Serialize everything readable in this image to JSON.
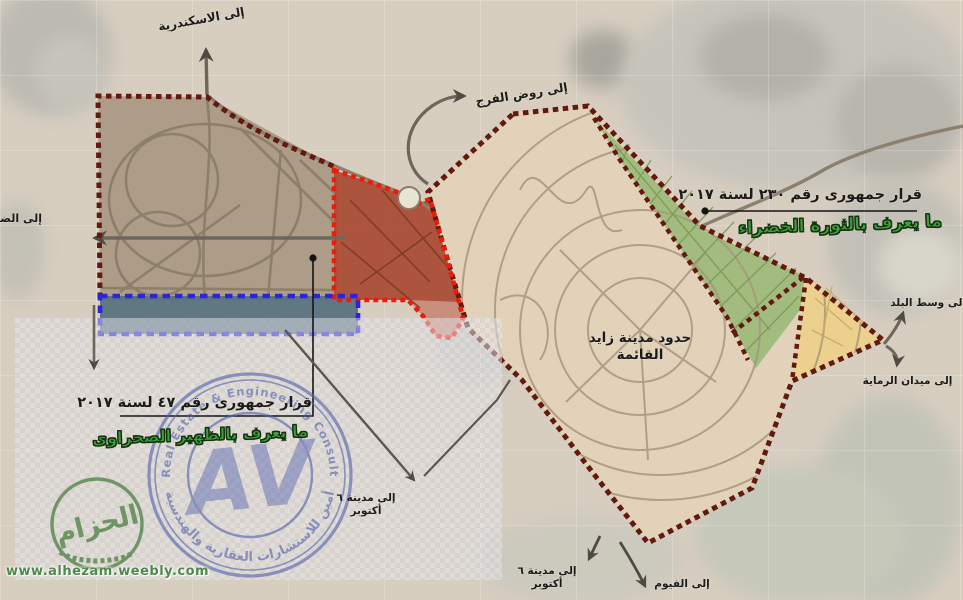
{
  "canvas": {
    "width": 963,
    "height": 600
  },
  "colors": {
    "sand": "#d8cec0",
    "zone-tan": "#ad9c87",
    "zone-beige": "#e2d2b9",
    "zone-green": "#a2bb7e",
    "zone-yellow": "#ecd08e",
    "zone-red": "#a84a32",
    "zone-red-light": "#c98f7d",
    "zone-slate": "#57707e",
    "dash-maroon": "#63190e",
    "dash-red": "#ee1b0a",
    "dash-blue": "#2b24d9",
    "road": "#6e665b",
    "road-light": "#8b7f6e",
    "ring-road": "#a8977c",
    "green-line": "#7d9a58",
    "yellow-line": "#c9ab67",
    "red-line": "#7d3a28",
    "ink": "#1b1b1b",
    "green-text": "#3da23d",
    "stamp-blue": "#5463ad",
    "logo-green": "#5d8a52",
    "url-green": "#4f8a4a"
  },
  "direction_labels": {
    "to_alexandria": "إلى الاسكندرية",
    "to_rawd_elfarag": "إلى روض الفرج",
    "to_dabaa": "إلى الضبعة",
    "to_wasat_elbalad": "إلى وسط البلد",
    "to_midan_elremaya": "إلى ميدان الرماية",
    "to_october_line1": "إلى مدينة ٦",
    "to_october_line2": "أكتوبر",
    "to_october2_line1": "إلى مدينة ٦",
    "to_october2_line2": "أكتوبر",
    "to_fayoum": "إلى الفيوم"
  },
  "city_label": {
    "line1": "حدود مدينة زايد",
    "line2": "القائمة"
  },
  "decrees": {
    "green_revolution": {
      "decree": "قرار جمهورى رقم ٢٣٠ لسنة ٢٠١٧",
      "known_as": "ما يعرف بالثورة الخضراء"
    },
    "desert_hinterland": {
      "decree": "قرار جمهورى رقم ٤٧ لسنة ٢٠١٧",
      "known_as": "ما يعرف بالظهير الصحراوى"
    }
  },
  "watermarks": {
    "stamp": {
      "english": "AVR Real Estate & Engineering Consultancy",
      "arabic": "أمين للاستشارات العقارية والهندسية",
      "monogram": "AV"
    },
    "hezam_logo": {
      "text": "الحزام",
      "url": "www.alhezam.weebly.com"
    }
  }
}
